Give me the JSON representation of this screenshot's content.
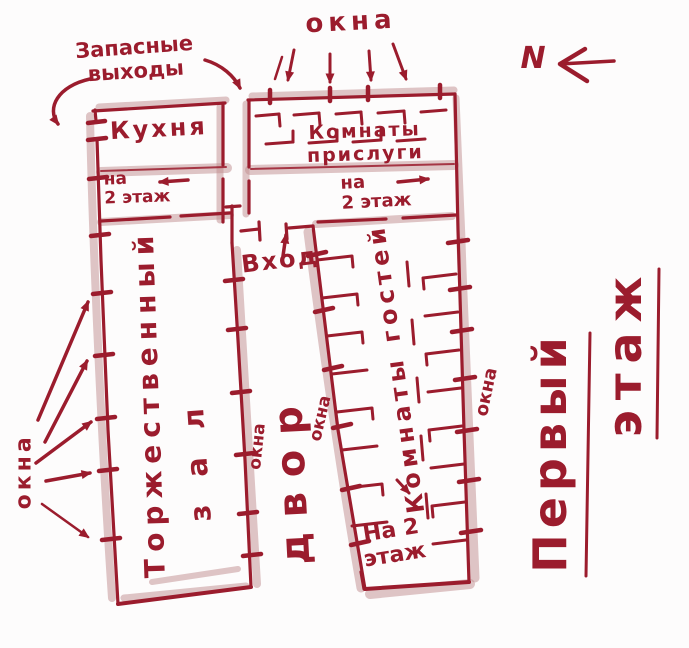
{
  "meta": {
    "description": "Hand-drawn sketch of a building first-floor plan, dark red ink on white paper"
  },
  "colors": {
    "ink": "#9b1c2d",
    "shade": "#c08c8e",
    "paper": "#fdfcfc"
  },
  "labels": {
    "emergency_exits": "Запасные\nвыходы",
    "windows_top": "окна",
    "north": "N",
    "kitchen": "Кухня",
    "stairs_left": "на\n2 этаж",
    "servants_rooms": "Комнаты\nприслуги",
    "stairs_right": "на\n2 этаж",
    "entrance": "Вход",
    "hall_word1": "Торжественный",
    "hall_word2": "зал",
    "courtyard": "двор",
    "windows_left": "окна",
    "windows_hall_courtyard": "окна",
    "windows_guest_courtyard": "окна",
    "guest_rooms": "Комнаты гостей",
    "windows_guest_right": "окна",
    "stairs_guest": "На 2\nэтаж",
    "floor_word1": "Первый",
    "floor_word2": "этаж"
  }
}
